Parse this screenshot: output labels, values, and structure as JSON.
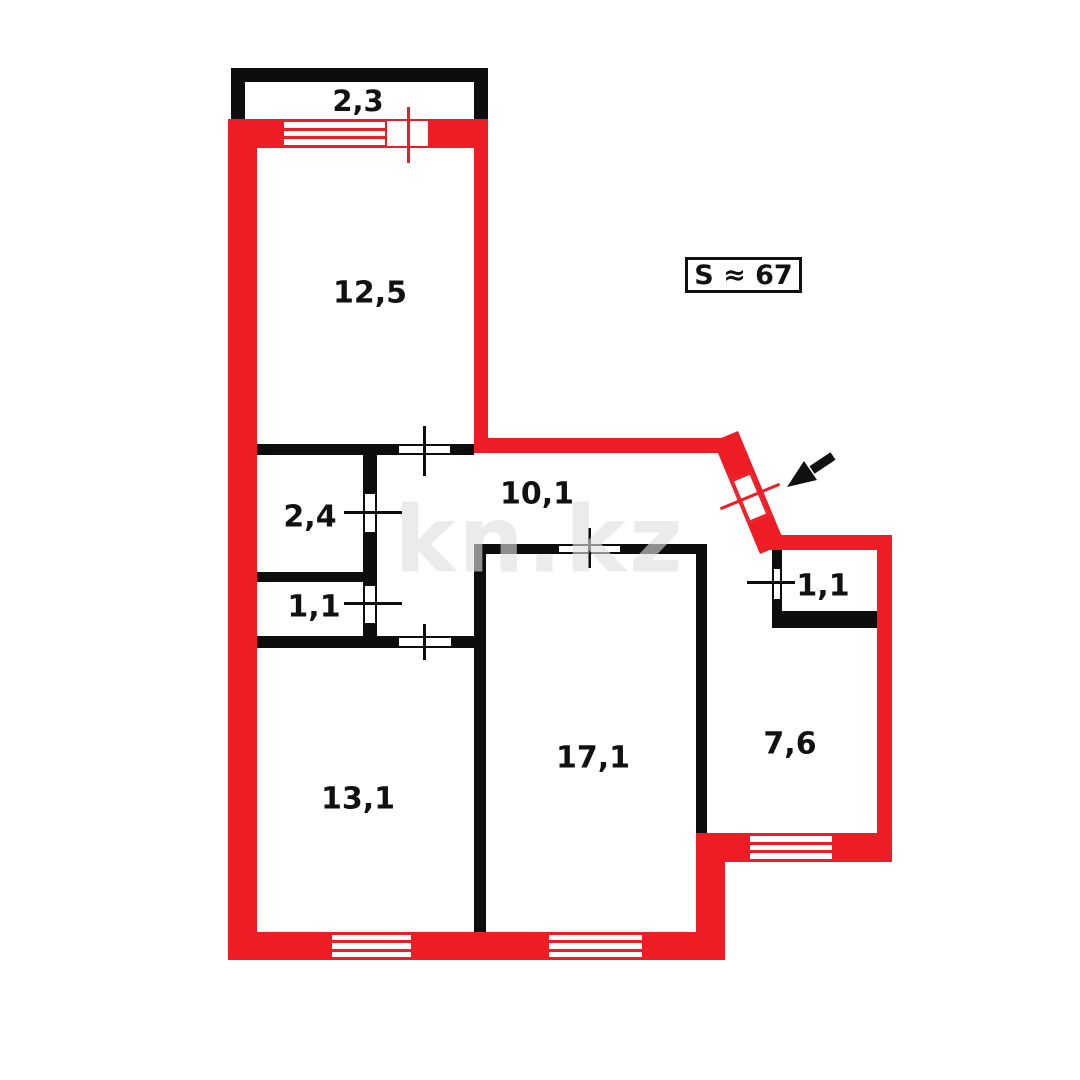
{
  "plan": {
    "title": "apartment-floor-plan",
    "total_area_label": "S ≈ 67",
    "watermark_text": "kn.kz",
    "rooms": [
      {
        "name": "balcony",
        "area_label": "2,3"
      },
      {
        "name": "bedroom-top",
        "area_label": "12,5"
      },
      {
        "name": "closet",
        "area_label": "2,4"
      },
      {
        "name": "bathroom-left",
        "area_label": "1,1"
      },
      {
        "name": "hallway",
        "area_label": "10,1"
      },
      {
        "name": "room-bottom-left",
        "area_label": "13,1"
      },
      {
        "name": "living-room",
        "area_label": "17,1"
      },
      {
        "name": "bathroom-right",
        "area_label": "1,1"
      },
      {
        "name": "kitchen",
        "area_label": "7,6"
      }
    ],
    "colors": {
      "exterior_wall": "#ee1c24",
      "interior_wall": "#0d0d0d",
      "watermark": "rgba(222,222,222,0.62)"
    },
    "icons": {
      "entrance_arrow": "black-arrow-pointing-down-left-at-entrance-door"
    }
  }
}
